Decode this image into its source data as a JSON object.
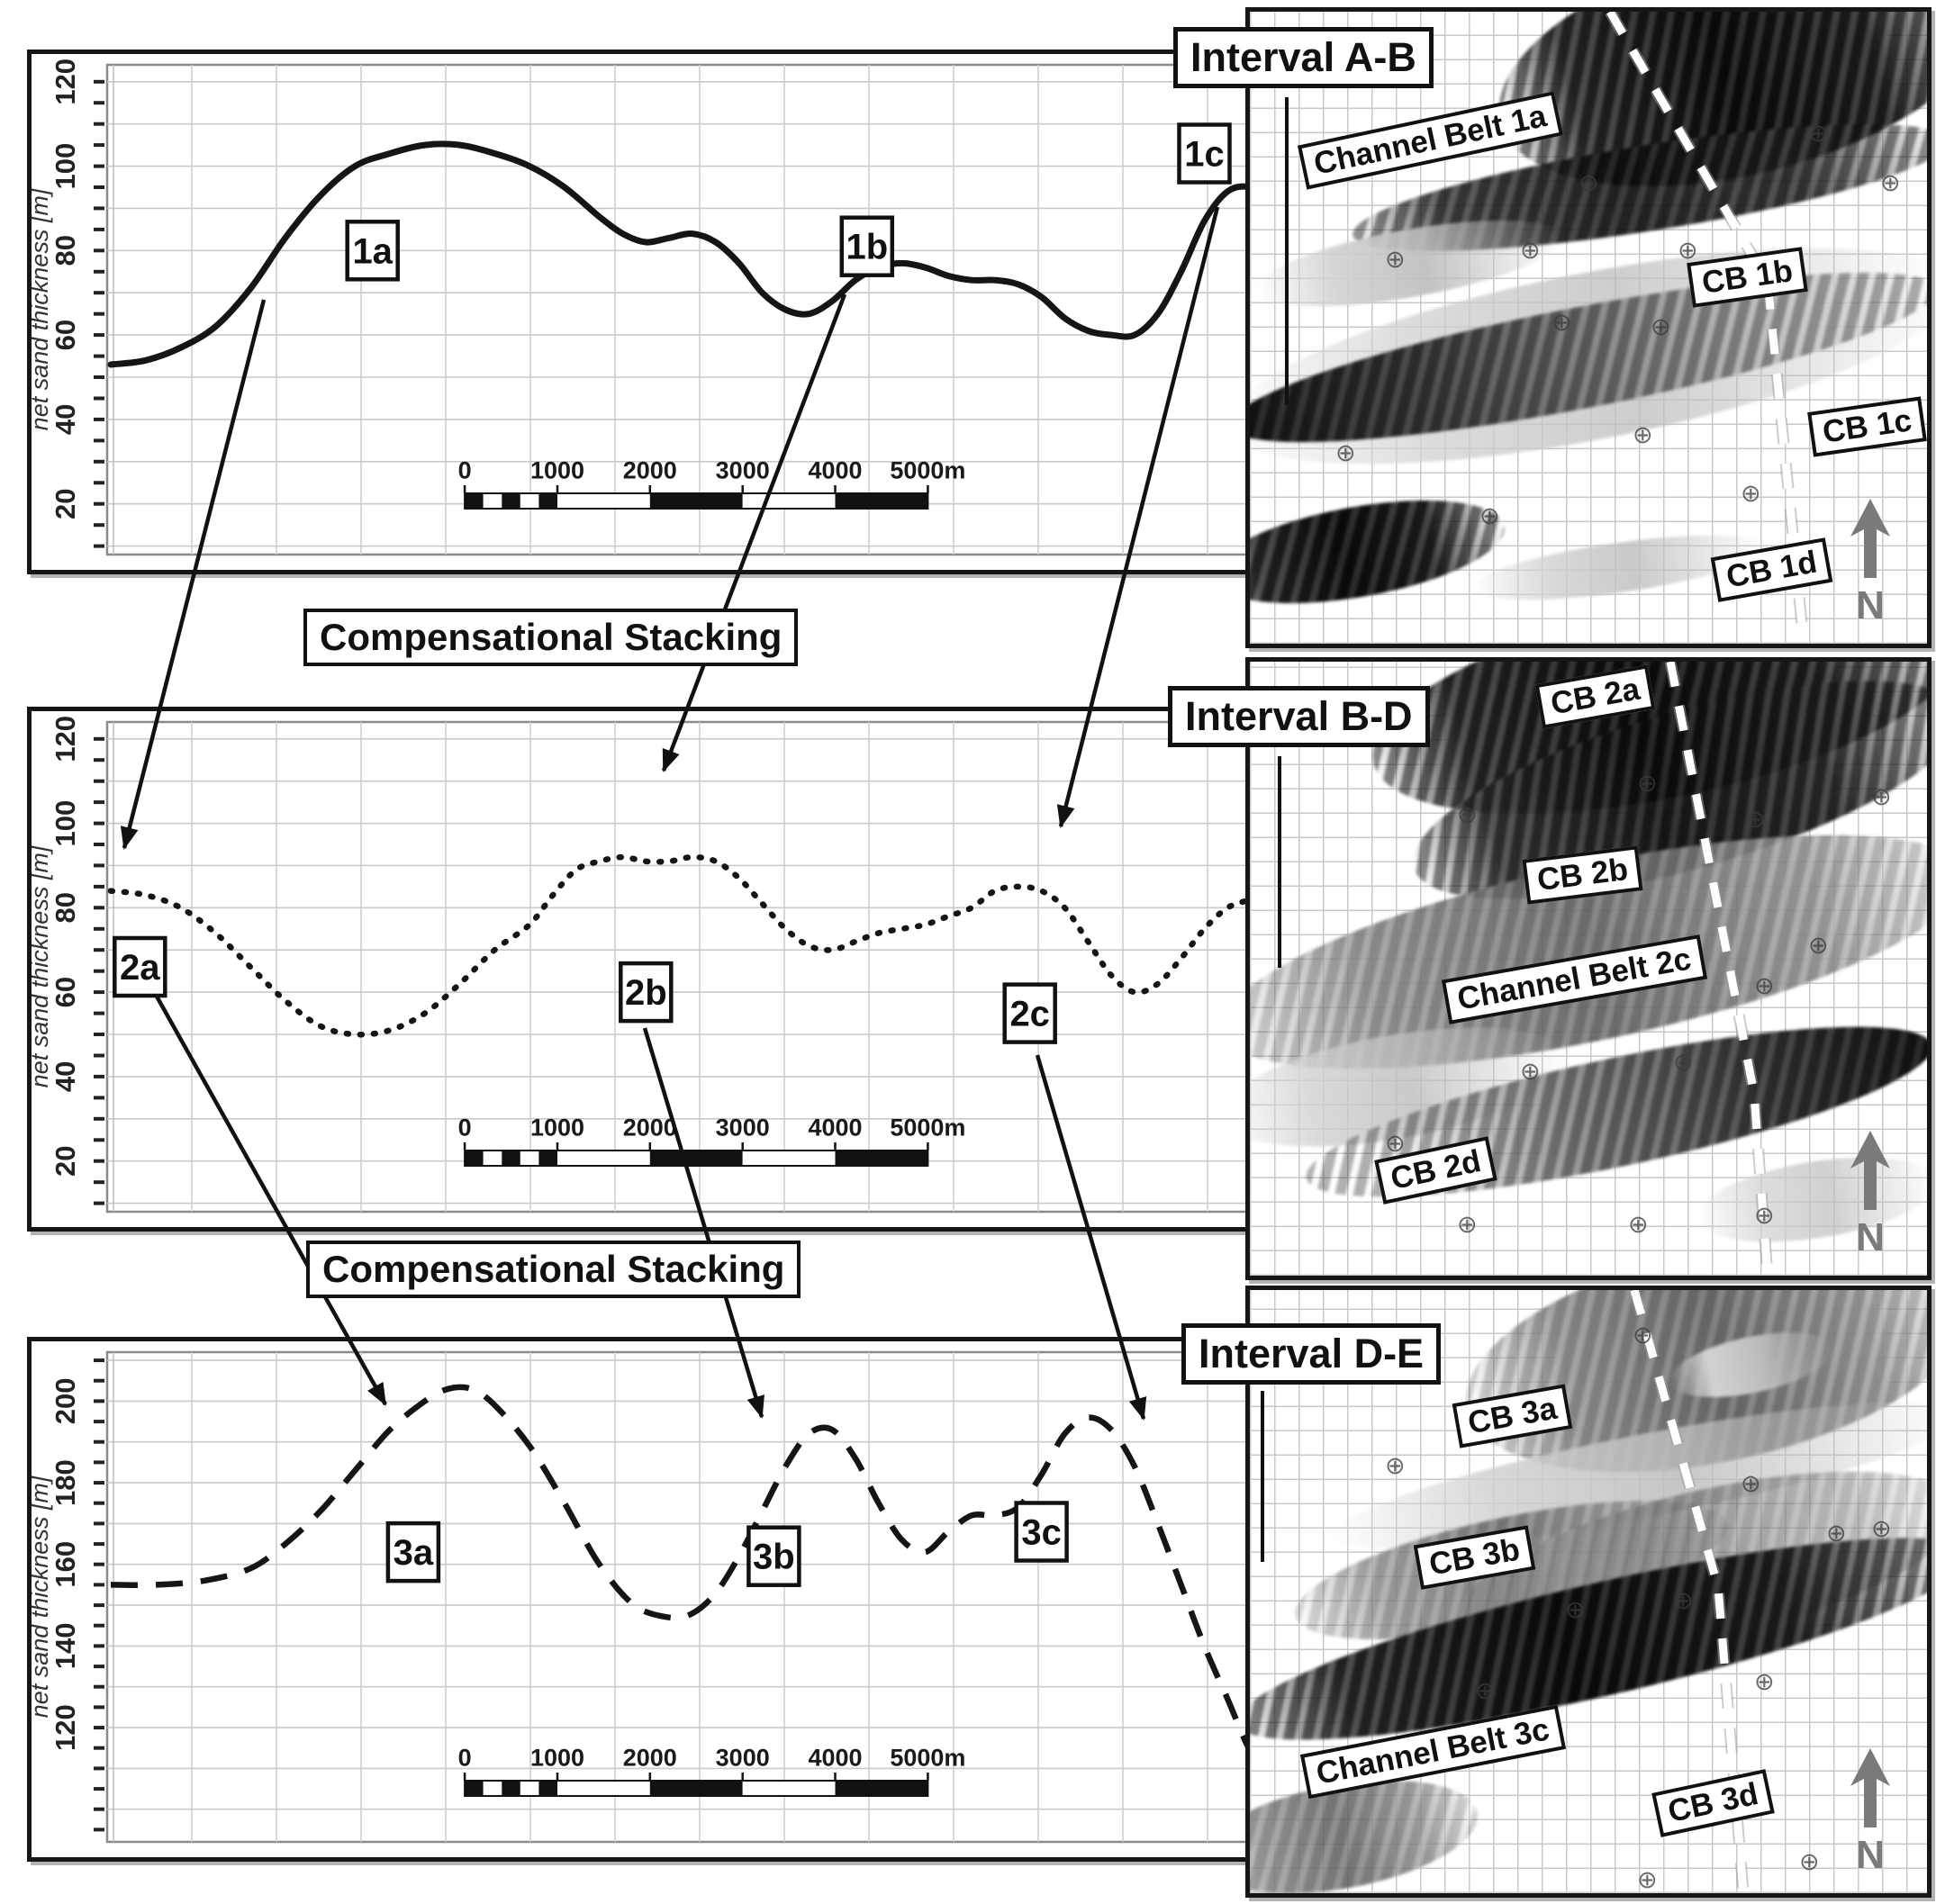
{
  "figure": {
    "compensational_stacking_labels": [
      "Compensational Stacking",
      "Compensational Stacking"
    ],
    "well_symbol": "⊕",
    "north_label": "N"
  },
  "chart_data": [
    {
      "type": "line",
      "interval": "Interval A-B",
      "ylabel": "net sand thickness [m]",
      "line_style": "solid",
      "ylim": [
        8,
        124
      ],
      "yticks": [
        20,
        40,
        60,
        80,
        100,
        120
      ],
      "ygrid_step": 10,
      "ytick_minor_step": 5,
      "scalebar_labels": [
        "0",
        "1000",
        "2000",
        "3000",
        "4000",
        "5000m"
      ],
      "point_labels": [
        {
          "text": "1a",
          "x": 22.5,
          "y": 80
        },
        {
          "text": "1b",
          "x": 65,
          "y": 81
        },
        {
          "text": "1c",
          "x": 94,
          "y": 103
        }
      ],
      "series": [
        {
          "name": "net sand thickness",
          "points": [
            [
              0,
              53
            ],
            [
              3,
              54
            ],
            [
              6,
              57
            ],
            [
              9,
              62
            ],
            [
              12,
              71
            ],
            [
              15,
              83
            ],
            [
              18,
              93
            ],
            [
              21,
              100
            ],
            [
              24,
              103
            ],
            [
              27,
              105
            ],
            [
              30,
              105
            ],
            [
              33,
              103
            ],
            [
              36,
              100
            ],
            [
              39,
              95
            ],
            [
              42,
              88
            ],
            [
              44,
              84
            ],
            [
              46,
              82
            ],
            [
              48,
              83
            ],
            [
              50,
              84
            ],
            [
              52,
              82
            ],
            [
              54,
              77
            ],
            [
              56,
              70
            ],
            [
              58,
              66
            ],
            [
              60,
              65
            ],
            [
              62,
              68
            ],
            [
              64,
              73
            ],
            [
              66,
              76
            ],
            [
              68,
              77
            ],
            [
              70,
              76
            ],
            [
              72,
              74
            ],
            [
              74,
              73
            ],
            [
              76,
              73
            ],
            [
              78,
              72
            ],
            [
              80,
              69
            ],
            [
              82,
              64
            ],
            [
              84,
              61
            ],
            [
              86,
              60
            ],
            [
              88,
              60
            ],
            [
              90,
              65
            ],
            [
              92,
              75
            ],
            [
              94,
              87
            ],
            [
              96,
              94
            ],
            [
              98,
              95
            ],
            [
              100,
              92
            ]
          ]
        }
      ]
    },
    {
      "type": "line",
      "interval": "Interval B-D",
      "ylabel": "net sand thickness [m]",
      "line_style": "dotted",
      "ylim": [
        8,
        124
      ],
      "yticks": [
        20,
        40,
        60,
        80,
        100,
        120
      ],
      "ygrid_step": 10,
      "ytick_minor_step": 5,
      "scalebar_labels": [
        "0",
        "1000",
        "2000",
        "3000",
        "4000",
        "5000m"
      ],
      "point_labels": [
        {
          "text": "2a",
          "x": 2.5,
          "y": 66
        },
        {
          "text": "2b",
          "x": 46,
          "y": 60
        },
        {
          "text": "2c",
          "x": 79,
          "y": 55
        }
      ],
      "series": [
        {
          "name": "net sand thickness",
          "points": [
            [
              0,
              84
            ],
            [
              3,
              83
            ],
            [
              6,
              80
            ],
            [
              9,
              74
            ],
            [
              12,
              66
            ],
            [
              15,
              58
            ],
            [
              18,
              52
            ],
            [
              21,
              50
            ],
            [
              24,
              51
            ],
            [
              27,
              55
            ],
            [
              30,
              62
            ],
            [
              33,
              70
            ],
            [
              36,
              76
            ],
            [
              38,
              83
            ],
            [
              40,
              89
            ],
            [
              42,
              91
            ],
            [
              44,
              92
            ],
            [
              46,
              91
            ],
            [
              48,
              91
            ],
            [
              50,
              92
            ],
            [
              52,
              91
            ],
            [
              54,
              87
            ],
            [
              56,
              81
            ],
            [
              58,
              75
            ],
            [
              60,
              71
            ],
            [
              62,
              70
            ],
            [
              64,
              72
            ],
            [
              66,
              74
            ],
            [
              68,
              75
            ],
            [
              70,
              76
            ],
            [
              72,
              78
            ],
            [
              74,
              80
            ],
            [
              76,
              84
            ],
            [
              78,
              85
            ],
            [
              80,
              84
            ],
            [
              82,
              80
            ],
            [
              84,
              72
            ],
            [
              86,
              64
            ],
            [
              88,
              60
            ],
            [
              90,
              62
            ],
            [
              92,
              68
            ],
            [
              94,
              75
            ],
            [
              96,
              80
            ],
            [
              98,
              82
            ],
            [
              100,
              84
            ]
          ]
        }
      ]
    },
    {
      "type": "line",
      "interval": "Interval D-E",
      "ylabel": "net sand thickness [m]",
      "line_style": "dashed",
      "ylim": [
        92,
        212
      ],
      "yticks": [
        120,
        140,
        160,
        180,
        200
      ],
      "ygrid_step": 10,
      "ytick_minor_step": 5,
      "scalebar_labels": [
        "0",
        "1000",
        "2000",
        "3000",
        "4000",
        "5000m"
      ],
      "point_labels": [
        {
          "text": "3a",
          "x": 26,
          "y": 163
        },
        {
          "text": "3b",
          "x": 57,
          "y": 162
        },
        {
          "text": "3c",
          "x": 80,
          "y": 168
        }
      ],
      "series": [
        {
          "name": "net sand thickness",
          "points": [
            [
              0,
              155
            ],
            [
              4,
              155
            ],
            [
              8,
              156
            ],
            [
              12,
              159
            ],
            [
              15,
              165
            ],
            [
              18,
              173
            ],
            [
              21,
              183
            ],
            [
              24,
              193
            ],
            [
              27,
              200
            ],
            [
              29,
              203
            ],
            [
              31,
              203
            ],
            [
              33,
              199
            ],
            [
              36,
              189
            ],
            [
              39,
              175
            ],
            [
              42,
              160
            ],
            [
              45,
              150
            ],
            [
              48,
              147
            ],
            [
              50,
              148
            ],
            [
              52,
              153
            ],
            [
              54,
              162
            ],
            [
              56,
              173
            ],
            [
              58,
              184
            ],
            [
              60,
              192
            ],
            [
              62,
              193
            ],
            [
              64,
              186
            ],
            [
              66,
              175
            ],
            [
              68,
              166
            ],
            [
              70,
              163
            ],
            [
              72,
              168
            ],
            [
              74,
              172
            ],
            [
              76,
              172
            ],
            [
              78,
              174
            ],
            [
              80,
              182
            ],
            [
              82,
              192
            ],
            [
              84,
              196
            ],
            [
              86,
              193
            ],
            [
              88,
              184
            ],
            [
              90,
              170
            ],
            [
              92,
              155
            ],
            [
              94,
              140
            ],
            [
              96,
              127
            ],
            [
              98,
              114
            ],
            [
              100,
              107
            ]
          ]
        }
      ]
    }
  ],
  "maps": [
    {
      "interval": "Interval A-B",
      "labels": [
        "Channel Belt 1a",
        "CB 1b",
        "CB 1c",
        "CB 1d"
      ]
    },
    {
      "interval": "Interval B-D",
      "labels": [
        "CB 2a",
        "CB 2b",
        "Channel Belt 2c",
        "CB 2d"
      ]
    },
    {
      "interval": "Interval D-E",
      "labels": [
        "CB 3a",
        "CB 3b",
        "Channel Belt 3c",
        "CB 3d"
      ]
    }
  ]
}
